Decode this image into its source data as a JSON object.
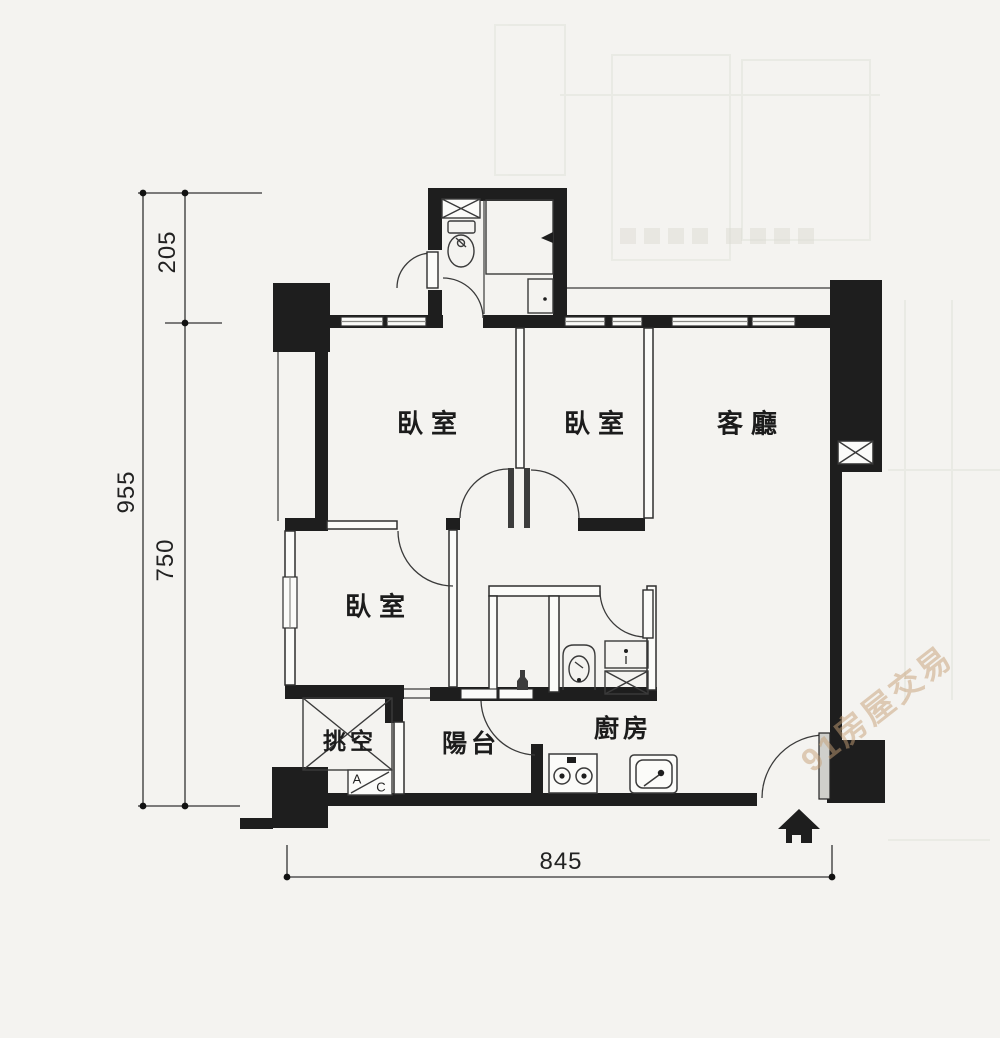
{
  "plan": {
    "title": "apartment floor plan",
    "rooms": {
      "bedroom_top_left": "臥室",
      "bedroom_top_mid": "臥室",
      "living": "客廳",
      "bedroom_left": "臥室",
      "void": "挑空",
      "balcony": "陽台",
      "kitchen": "廚房"
    },
    "dimensions": {
      "total_height": "955",
      "top_height": "205",
      "lower_height": "750",
      "width": "845"
    },
    "ac_unit": {
      "a": "A",
      "c": "C"
    },
    "watermark": {
      "text": "91房屋交易"
    },
    "colors": {
      "paper": "#f4f3f0",
      "wall": "#1e1e1e",
      "line": "#2e2e2e",
      "watermark": "#c6a076"
    }
  }
}
